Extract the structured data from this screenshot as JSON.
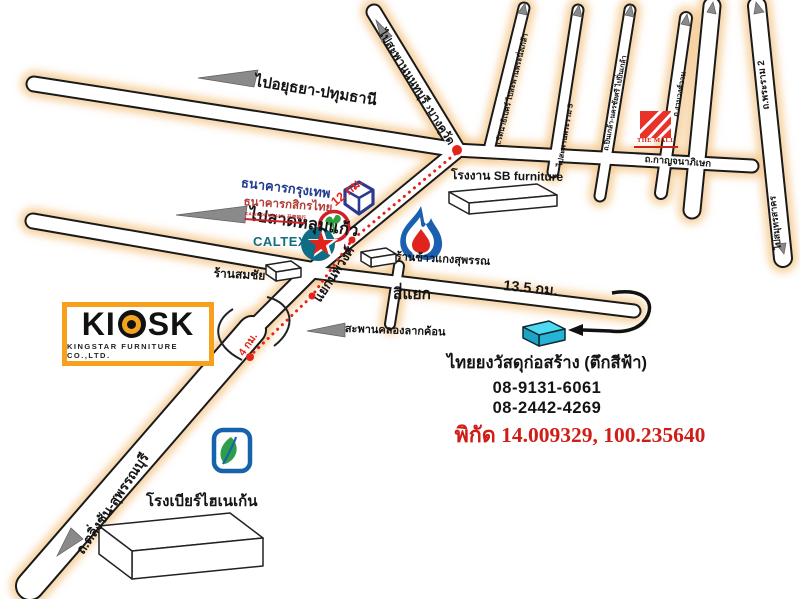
{
  "map": {
    "roads": {
      "to_ayutthaya": "ไปอยุธยา-ปทุมธานี",
      "to_nonthaburi_bridge": "ไปสะพานนนทบุรี ›บางคูวัด",
      "rattanathibet": "ถ.รัตนาธิเบศร์ ไปสะพานพระนั่งเกล้า",
      "to_rama5_bridge": "ไปสะพานพระราม 5",
      "pinklao": "ถ.ปิ่นเกล้า-นครชัยศรี ไปปิ่นเกล้า",
      "ngamwongwan": "ถ.งามวงศ์วาน",
      "kanchanaphisek": "ถ.กาญจนาภิเษก",
      "rama2": "ถ.พระราม 2",
      "to_samut_sakhon": "ไปสมุทรสาคร",
      "to_lat_lum_kaeo": "ไปลาดหลุมแก้ว",
      "talingchan_suphanburi": "ถ.ตลิ่งชัน-สุพรรณบุรี",
      "nopphawong_junction": "แยกนพวงศ์",
      "si_yaek": "สี่แยก",
      "khlong_bridge": "สะพานคลองลากค้อน"
    },
    "distances": {
      "km12": "12 กม.",
      "km4": "4 กม.",
      "km13_5": "13.5 กม."
    },
    "landmarks": {
      "bangkok_bank": "ธนาคารกรุงเทพ",
      "kasikorn_bank": "ธนาคารกสิกรไทย",
      "kasikorn_sub": "KASIKORNBANK 开泰银行",
      "caltex": "CALTEX",
      "somchai_shop": "ร้านสมชัย",
      "rice_shop": "ร้านข้าวแกงสุพรรณ",
      "sb_factory": "โรงงาน SB furniture",
      "the_mall": "THE MALL",
      "heineken_brewery": "โรงเบียร์ไฮเนเก้น"
    },
    "kiosk": {
      "brand_left": "KI",
      "brand_right": "SK",
      "subtitle": "KINGSTAR FURNITURE CO.,LTD."
    },
    "destination": {
      "name": "ไทยยงวัสดุก่อสร้าง (ตึกสีฟ้า)",
      "phone1": "08-9131-6061",
      "phone2": "08-2442-4269",
      "coordinates": "พิกัด 14.009329, 100.235640"
    },
    "colors": {
      "route_red": "#e32519",
      "coord_red": "#cf1d17",
      "mall_red": "#d21f1a",
      "bbl_blue": "#2b3990",
      "kbank_red": "#d0202a",
      "kbank_green": "#2f9e41",
      "caltex_teal": "#0f6d86",
      "caltex_star_red": "#e0231c",
      "ptt_blue": "#1a5fb0",
      "ptt_red": "#e0231c",
      "bangchak_blue": "#1663ad",
      "bangchak_green": "#2f9e4b",
      "kiosk_orange": "#f7a01b",
      "cyan_building": "#4ed9f0"
    }
  }
}
